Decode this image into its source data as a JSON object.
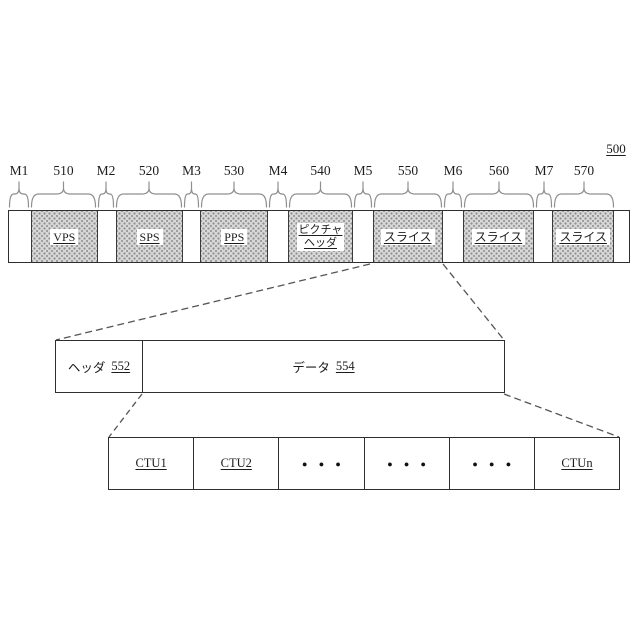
{
  "figure": {
    "number": "500"
  },
  "colors": {
    "hatch_fill": "#d8d8d8",
    "hatch_dot": "#8d8d8d",
    "line": "#2f2f2f",
    "brace": "#8f8f8f"
  },
  "bar": {
    "segments": [
      {
        "ref": "M1",
        "type": "marker"
      },
      {
        "ref": "510",
        "type": "data",
        "label": "VPS"
      },
      {
        "ref": "M2",
        "type": "marker"
      },
      {
        "ref": "520",
        "type": "data",
        "label": "SPS"
      },
      {
        "ref": "M3",
        "type": "marker"
      },
      {
        "ref": "530",
        "type": "data",
        "label": "PPS"
      },
      {
        "ref": "M4",
        "type": "marker"
      },
      {
        "ref": "540",
        "type": "data",
        "label": "ピクチャ",
        "label2": "ヘッダ"
      },
      {
        "ref": "M5",
        "type": "marker"
      },
      {
        "ref": "550",
        "type": "data",
        "label": "スライス"
      },
      {
        "ref": "M6",
        "type": "marker"
      },
      {
        "ref": "560",
        "type": "data",
        "label": "スライス"
      },
      {
        "ref": "M7",
        "type": "marker"
      },
      {
        "ref": "570",
        "type": "data",
        "label": "スライス"
      }
    ]
  },
  "slice_detail": {
    "header_label": "ヘッダ",
    "header_ref": "552",
    "data_label": "データ",
    "data_ref": "554"
  },
  "ctu_detail": {
    "cells": [
      {
        "label": "CTU1",
        "dots": false
      },
      {
        "label": "CTU2",
        "dots": false
      },
      {
        "label": "● ● ●",
        "dots": true
      },
      {
        "label": "● ● ●",
        "dots": true
      },
      {
        "label": "● ● ●",
        "dots": true
      },
      {
        "label": "CTUn",
        "dots": false
      }
    ]
  }
}
